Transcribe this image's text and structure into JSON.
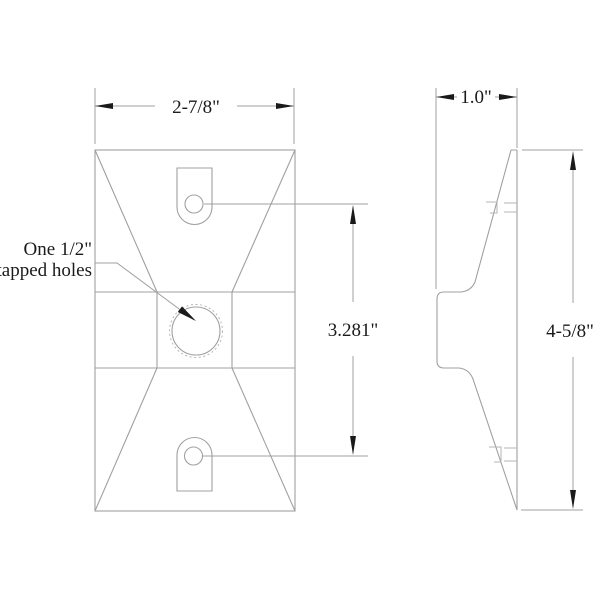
{
  "colors": {
    "line": "#a0a0a0",
    "line_light": "#b5b5b5",
    "ink": "#1a1a1a",
    "background": "#ffffff"
  },
  "drawing": {
    "front_view": {
      "dim_width": "2-7/8\"",
      "dim_hole_spacing": "3.281\"",
      "note_line1": "One 1/2\"",
      "note_line2": "tapped holes"
    },
    "side_view": {
      "dim_depth": "1.0\"",
      "dim_height": "4-5/8\""
    }
  }
}
